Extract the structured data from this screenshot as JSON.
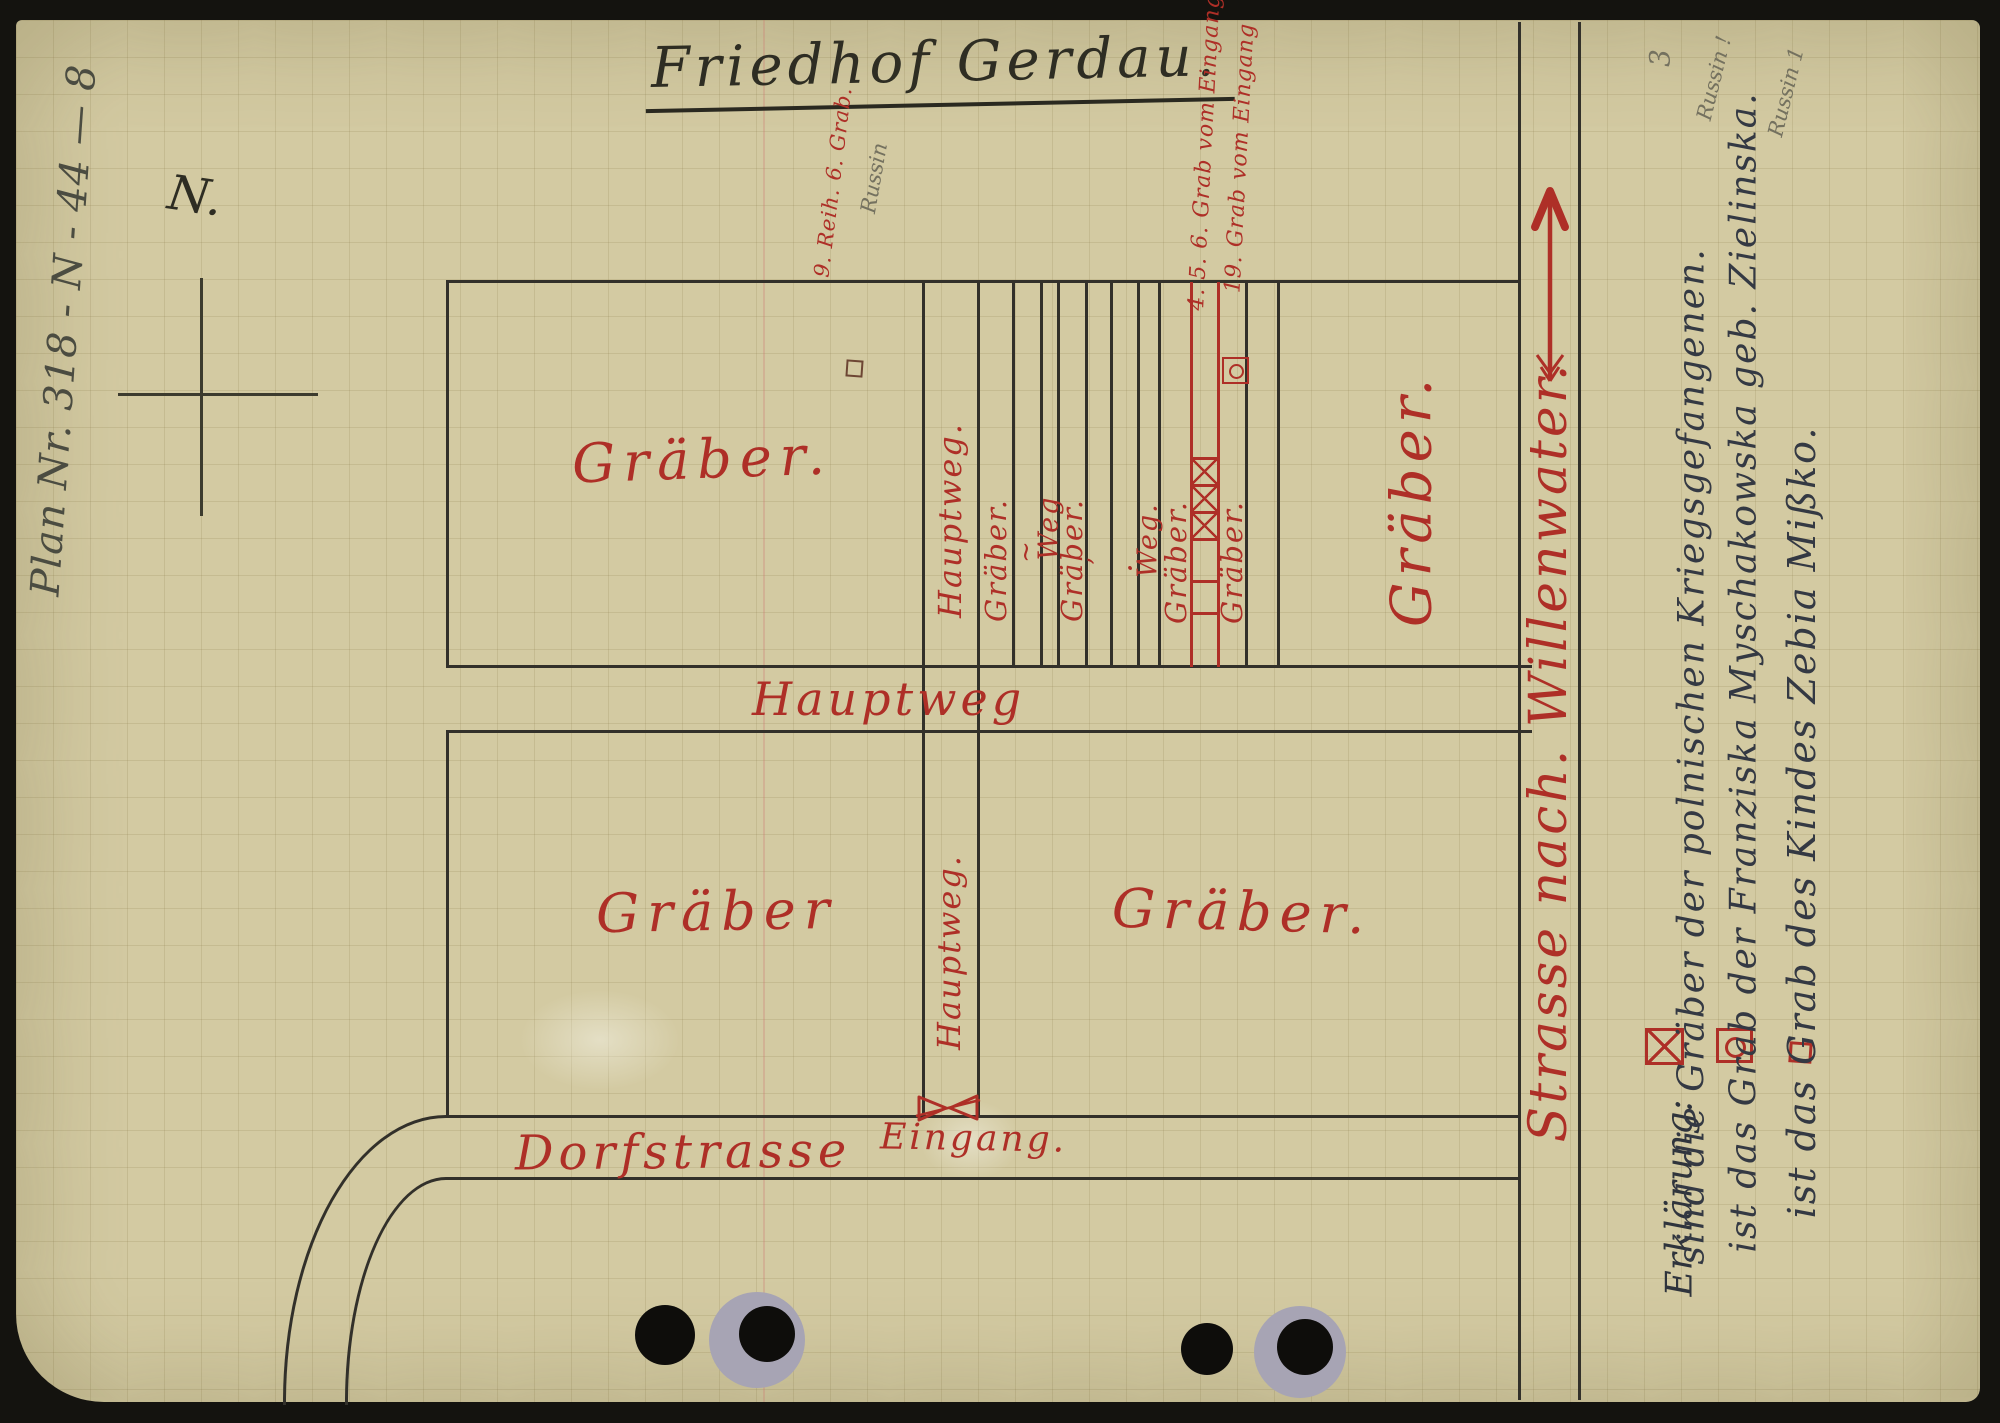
{
  "document": {
    "title": "Friedhof Gerdau.",
    "margin_ref": "Plan Nr. 318 - N - 44 — 8",
    "north_label": "N.",
    "corner_pencil_number": "3"
  },
  "map": {
    "fields": {
      "upper_left": "Gräber.",
      "lower_left": "Gräber",
      "lower_right": "Gräber.",
      "right_large": "Gräber."
    },
    "paths": {
      "main_path_band": "Hauptweg",
      "main_path_upper_strip": "Hauptweg.",
      "main_path_lower_strip": "Hauptweg.",
      "strip_labels": [
        "Gräber.",
        "~",
        "Weg",
        "Gräber.",
        "ʼ",
        ".",
        "Weg.",
        "Gräber.",
        "Gräber."
      ]
    },
    "streets": {
      "village_street": "Dorfstrasse",
      "entrance": "Eingang.",
      "road_to": "Strasse nach. Willenwater."
    },
    "annotations": {
      "grave_note_row": "9. Reih. 6. Grab.",
      "grave_note_row_pencil": "Russin",
      "grave_note_456": "4. 5. 6. Grab vom Eingang.",
      "grave_note_19": "19. Grab vom Eingang"
    }
  },
  "legend": {
    "heading": "Erklärung:",
    "entries": [
      {
        "symbol": "box-x-icon",
        "text": "sind die Gräber der polnischen Kriegsgefangenen."
      },
      {
        "symbol": "box-circle-icon",
        "text": "ist das Grab der Franziska Myschakowska geb. Zielinska."
      },
      {
        "symbol": "box-plain-icon",
        "text": "ist das Grab des Kindes Zebia Mißko."
      }
    ],
    "pencil_notes": {
      "note_1": "Russin !",
      "note_2": "Russin 1"
    }
  },
  "colors": {
    "paper": "#d3caa2",
    "red_ink": "#ae2f27",
    "black_ink": "#2e2d23",
    "legend_ink": "#343943",
    "pencil": "#74715f",
    "punch_ring": "#a7a4b4"
  }
}
